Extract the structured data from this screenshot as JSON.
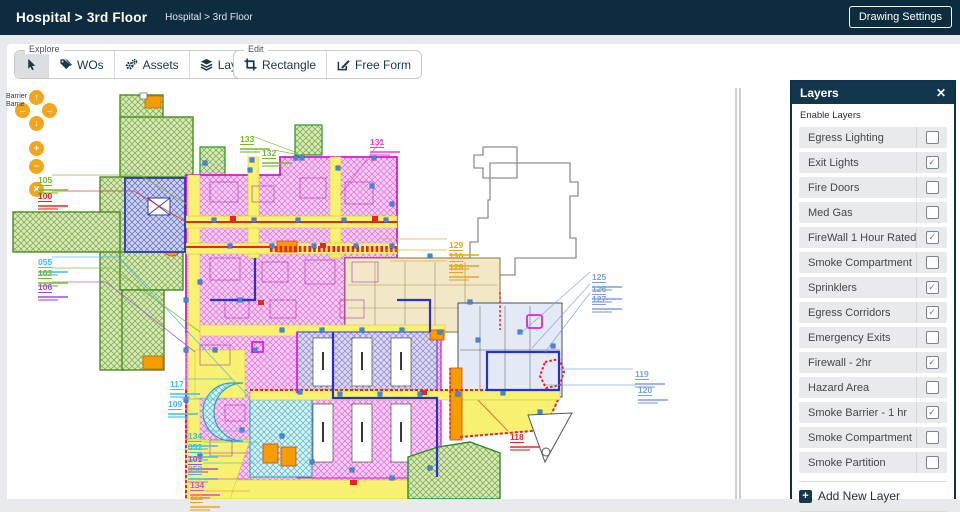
{
  "header": {
    "title": "Hospital > 3rd Floor",
    "breadcrumb": "Hospital > 3rd Floor",
    "drawing_settings_label": "Drawing Settings"
  },
  "toolbar": {
    "groups": [
      {
        "label": "Explore",
        "items": [
          {
            "icon": "cursor-icon",
            "label": "",
            "name": "select-tool-button",
            "active": true
          },
          {
            "icon": "tags-icon",
            "label": "WOs",
            "name": "wos-tool-button",
            "active": false
          },
          {
            "icon": "gears-icon",
            "label": "Assets",
            "name": "assets-tool-button",
            "active": false
          },
          {
            "icon": "layers-icon",
            "label": "Layers",
            "name": "layers-tool-button",
            "active": false
          },
          {
            "icon": "pie-chart-icon",
            "label": "Usage",
            "name": "usage-tool-button",
            "active": false
          }
        ]
      },
      {
        "label": "Edit",
        "items": [
          {
            "icon": "crop-icon",
            "label": "Rectangle",
            "name": "rectangle-tool-button",
            "active": false
          },
          {
            "icon": "edit-icon",
            "label": "Free Form",
            "name": "free-form-tool-button",
            "active": false
          }
        ]
      }
    ]
  },
  "pan_controls": {
    "buttons": [
      {
        "icon": "arrow-up-icon",
        "name": "pan-up-button"
      },
      {
        "icon": "arrow-left-icon",
        "name": "pan-left-button"
      },
      {
        "icon": "arrow-right-icon",
        "name": "pan-right-button"
      },
      {
        "icon": "arrow-down-icon",
        "name": "pan-down-button"
      },
      {
        "icon": "plus-icon",
        "name": "zoom-in-button"
      },
      {
        "icon": "minus-icon",
        "name": "zoom-out-button"
      },
      {
        "icon": "close-circle-icon",
        "name": "reset-view-button"
      }
    ]
  },
  "canvas": {
    "barrier_line1": "Barrier",
    "barrier_line2": "Barrie"
  },
  "plan_labels": [
    {
      "text": "105",
      "color": "#76b82a",
      "x": 38,
      "y": 171
    },
    {
      "text": "100",
      "color": "#e8251f",
      "x": 38,
      "y": 187
    },
    {
      "text": "055",
      "color": "#45b8e8",
      "x": 38,
      "y": 253
    },
    {
      "text": "103",
      "color": "#76b82a",
      "x": 38,
      "y": 264
    },
    {
      "text": "106",
      "color": "#9c4fd4",
      "x": 38,
      "y": 278
    },
    {
      "text": "133",
      "color": "#76b82a",
      "x": 240,
      "y": 130
    },
    {
      "text": "132",
      "color": "#76b82a",
      "x": 262,
      "y": 144
    },
    {
      "text": "131",
      "color": "#ee3fd4",
      "x": 370,
      "y": 133
    },
    {
      "text": "129",
      "color": "#eba417",
      "x": 449,
      "y": 236
    },
    {
      "text": "130",
      "color": "#eba417",
      "x": 449,
      "y": 247
    },
    {
      "text": "128",
      "color": "#eba417",
      "x": 449,
      "y": 258
    },
    {
      "text": "125",
      "color": "#7d9fe0",
      "x": 592,
      "y": 268
    },
    {
      "text": "126",
      "color": "#7d9fe0",
      "x": 592,
      "y": 280
    },
    {
      "text": "127",
      "color": "#7d9fe0",
      "x": 592,
      "y": 290
    },
    {
      "text": "117",
      "color": "#45b8e8",
      "x": 170,
      "y": 375
    },
    {
      "text": "109",
      "color": "#45b8e8",
      "x": 168,
      "y": 395
    },
    {
      "text": "134",
      "color": "#45b8e8",
      "x": 188,
      "y": 427
    },
    {
      "text": "052",
      "color": "#45b8e8",
      "x": 188,
      "y": 438
    },
    {
      "text": "101",
      "color": "#9c4fd4",
      "x": 188,
      "y": 450
    },
    {
      "text": "053",
      "color": "#45b8e8",
      "x": 188,
      "y": 460
    },
    {
      "text": "134",
      "color": "#ee3fd4",
      "x": 190,
      "y": 476
    },
    {
      "text": "111",
      "color": "#eba417",
      "x": 190,
      "y": 488
    },
    {
      "text": "119",
      "color": "#7d9fe0",
      "x": 635,
      "y": 365
    },
    {
      "text": "120",
      "color": "#7d9fe0",
      "x": 638,
      "y": 381
    },
    {
      "text": "118",
      "color": "#e8251f",
      "x": 510,
      "y": 428
    }
  ],
  "layers_panel": {
    "title": "Layers",
    "close_label": "✕",
    "subtitle": "Enable Layers",
    "check_glyph": "✓",
    "add_label": "Add New Layer",
    "layers": [
      {
        "name": "Egress Lighting",
        "checked": false
      },
      {
        "name": "Exit Lights",
        "checked": true
      },
      {
        "name": "Fire Doors",
        "checked": false
      },
      {
        "name": "Med Gas",
        "checked": false
      },
      {
        "name": "FireWall 1 Hour Rated",
        "checked": true
      },
      {
        "name": "Smoke Compartment",
        "checked": false
      },
      {
        "name": "Sprinklers",
        "checked": true
      },
      {
        "name": "Egress Corridors",
        "checked": true
      },
      {
        "name": "Emergency Exits",
        "checked": false
      },
      {
        "name": "Firewall - 2hr",
        "checked": true
      },
      {
        "name": "Hazard Area",
        "checked": false
      },
      {
        "name": "Smoke Barrier - 1 hr",
        "checked": true
      },
      {
        "name": "Smoke Compartment",
        "checked": false
      },
      {
        "name": "Smoke Partition",
        "checked": false
      }
    ]
  },
  "colors": {
    "header_bg": "#0d2c3f",
    "panel_header_bg": "#12374d",
    "accent_orange": "#f2a51d",
    "plan_green": "#4c8c26",
    "plan_pink": "#d816d3",
    "plan_blue": "#2b3bb4",
    "plan_red": "#e8251f",
    "plan_yellow": "#f8f171",
    "plan_cyan": "#2aa3bb",
    "plan_orange": "#f59c00"
  }
}
